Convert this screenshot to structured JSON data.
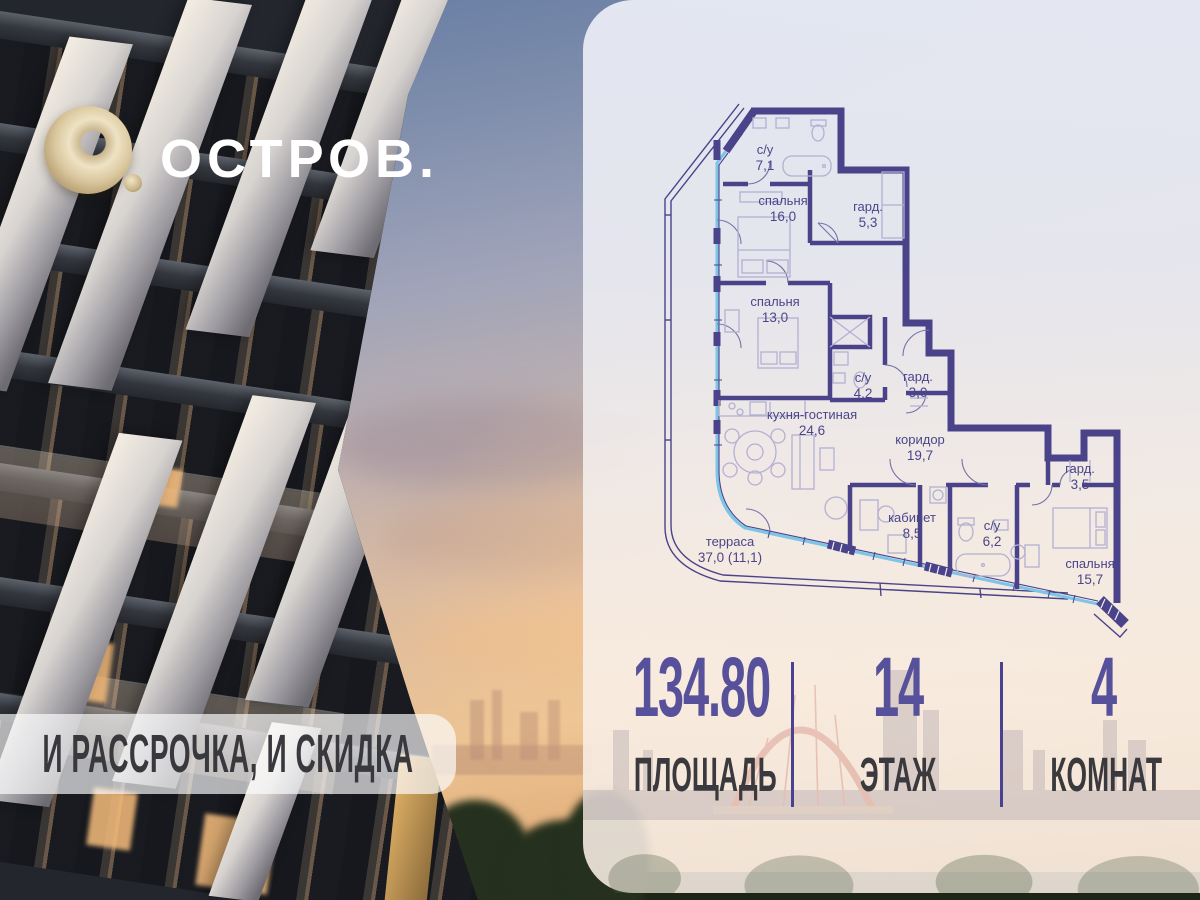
{
  "logo": {
    "brand": "ОСТРОВ."
  },
  "promo_banner": {
    "text": "И РАССРОЧКА, И СКИДКА"
  },
  "floor_plan": {
    "rooms": [
      {
        "name": "с/у",
        "area": "7,1"
      },
      {
        "name": "спальня",
        "area": "16,0"
      },
      {
        "name": "гард.",
        "area": "5,3"
      },
      {
        "name": "спальня",
        "area": "13,0"
      },
      {
        "name": "с/у",
        "area": "4,2"
      },
      {
        "name": "гард.",
        "area": "3,0"
      },
      {
        "name": "кухня-гостиная",
        "area": "24,6"
      },
      {
        "name": "коридор",
        "area": "19,7"
      },
      {
        "name": "кабинет",
        "area": "8,5"
      },
      {
        "name": "гард.",
        "area": "3,5"
      },
      {
        "name": "с/у",
        "area": "6,2"
      },
      {
        "name": "спальня",
        "area": "15,7"
      },
      {
        "name": "терраса",
        "area": "37,0 (11,1)"
      }
    ]
  },
  "stats": {
    "items": [
      {
        "value": "134.80",
        "label": "ПЛОЩАДЬ"
      },
      {
        "value": "14",
        "label": "ЭТАЖ"
      },
      {
        "value": "4",
        "label": "КОМНАТ"
      }
    ]
  },
  "colors": {
    "walls": "#4a4389",
    "accent_purple": "#57509a",
    "label_dark": "#3a393e",
    "glazing_blue": "#7cc4e8",
    "logo_gold": "#d9c69d"
  }
}
